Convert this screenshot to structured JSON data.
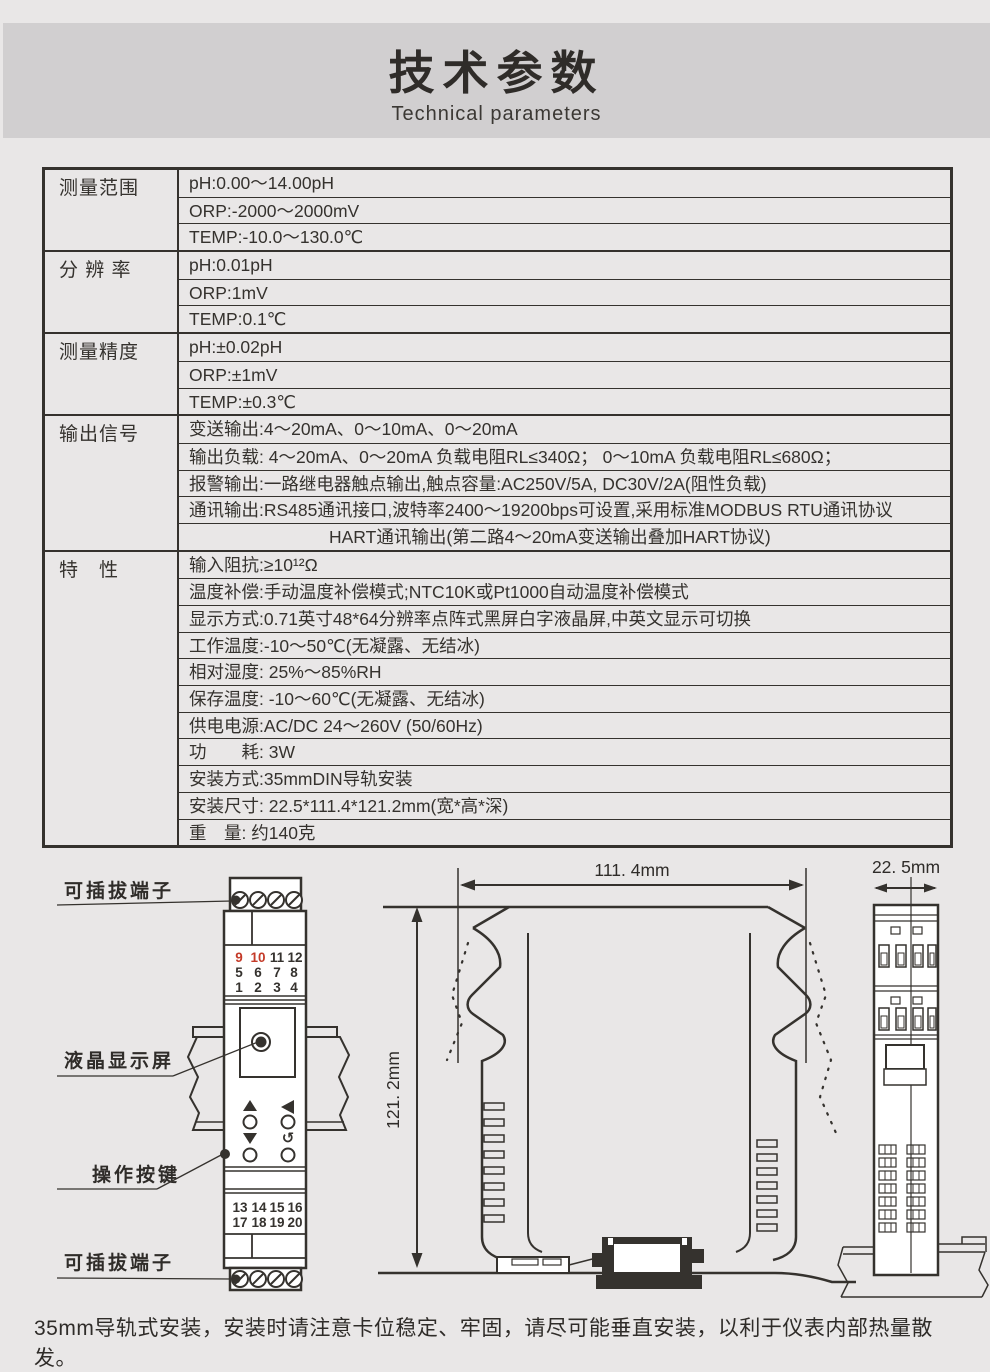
{
  "page": {
    "title": "技术参数",
    "subtitle": "Technical parameters",
    "footer_note": "35mm导轨式安装，安装时请注意卡位稳定、牢固，请尽可能垂直安装，以利于仪表内部热量散发。"
  },
  "colors": {
    "page_bg": "#e9e7e7",
    "banner_bg": "#d1cfd0",
    "ink": "#35322e",
    "terminal_red": "#c43a28"
  },
  "spec_table": {
    "rows": [
      {
        "category": "测量范围",
        "items": [
          "pH:0.00～14.00pH",
          "ORP:-2000～2000mV",
          "TEMP:-10.0～130.0℃"
        ]
      },
      {
        "category": "分 辨 率",
        "items": [
          "pH:0.01pH",
          "ORP:1mV",
          "TEMP:0.1℃"
        ]
      },
      {
        "category": "测量精度",
        "items": [
          "pH:±0.02pH",
          "ORP:±1mV",
          "TEMP:±0.3℃"
        ]
      },
      {
        "category": "输出信号",
        "items": [
          "变送输出:4～20mA、0～10mA、0～20mA",
          "输出负载: 4～20mA、0～20mA 负载电阻RL≤340Ω； 0～10mA 负载电阻RL≤680Ω；",
          "报警输出:一路继电器触点输出,触点容量:AC250V/5A, DC30V/2A(阻性负载)",
          "通讯输出:RS485通讯接口,波特率2400～19200bps可设置,采用标准MODBUS RTU通讯协议",
          "HART通讯输出(第二路4～20mA变送输出叠加HART协议)"
        ]
      },
      {
        "category": "特　性",
        "items": [
          "输入阻抗:≥10¹²Ω",
          "温度补偿:手动温度补偿模式;NTC10K或Pt1000自动温度补偿模式",
          "显示方式:0.71英寸48*64分辨率点阵式黑屏白字液晶屏,中英文显示可切换",
          "工作温度:-10～50℃(无凝露、无结冰)",
          "相对湿度: 25%～85%RH",
          "保存温度: -10～60℃(无凝露、无结冰)",
          "供电电源:AC/DC 24～260V (50/60Hz)",
          "功　　耗: 3W",
          "安装方式:35mmDIN导轨安装",
          "安装尺寸: 22.5*111.4*121.2mm(宽*高*深)",
          "重　量: 约140克"
        ]
      }
    ]
  },
  "diagram": {
    "labels": {
      "top_terminal": "可插拔端子",
      "lcd": "液晶显示屏",
      "buttons": "操作按键",
      "bottom_terminal": "可插拔端子"
    },
    "dimensions": {
      "width": "111. 4mm",
      "depth": "121. 2mm",
      "panel_width": "22. 5mm"
    },
    "front": {
      "top_rows": [
        [
          "9",
          "10",
          "11",
          "12"
        ],
        [
          "5",
          "6",
          "7",
          "8"
        ],
        [
          "1",
          "2",
          "3",
          "4"
        ]
      ],
      "bottom_rows": [
        [
          "13",
          "14",
          "15",
          "16"
        ],
        [
          "17",
          "18",
          "19",
          "20"
        ]
      ]
    }
  }
}
